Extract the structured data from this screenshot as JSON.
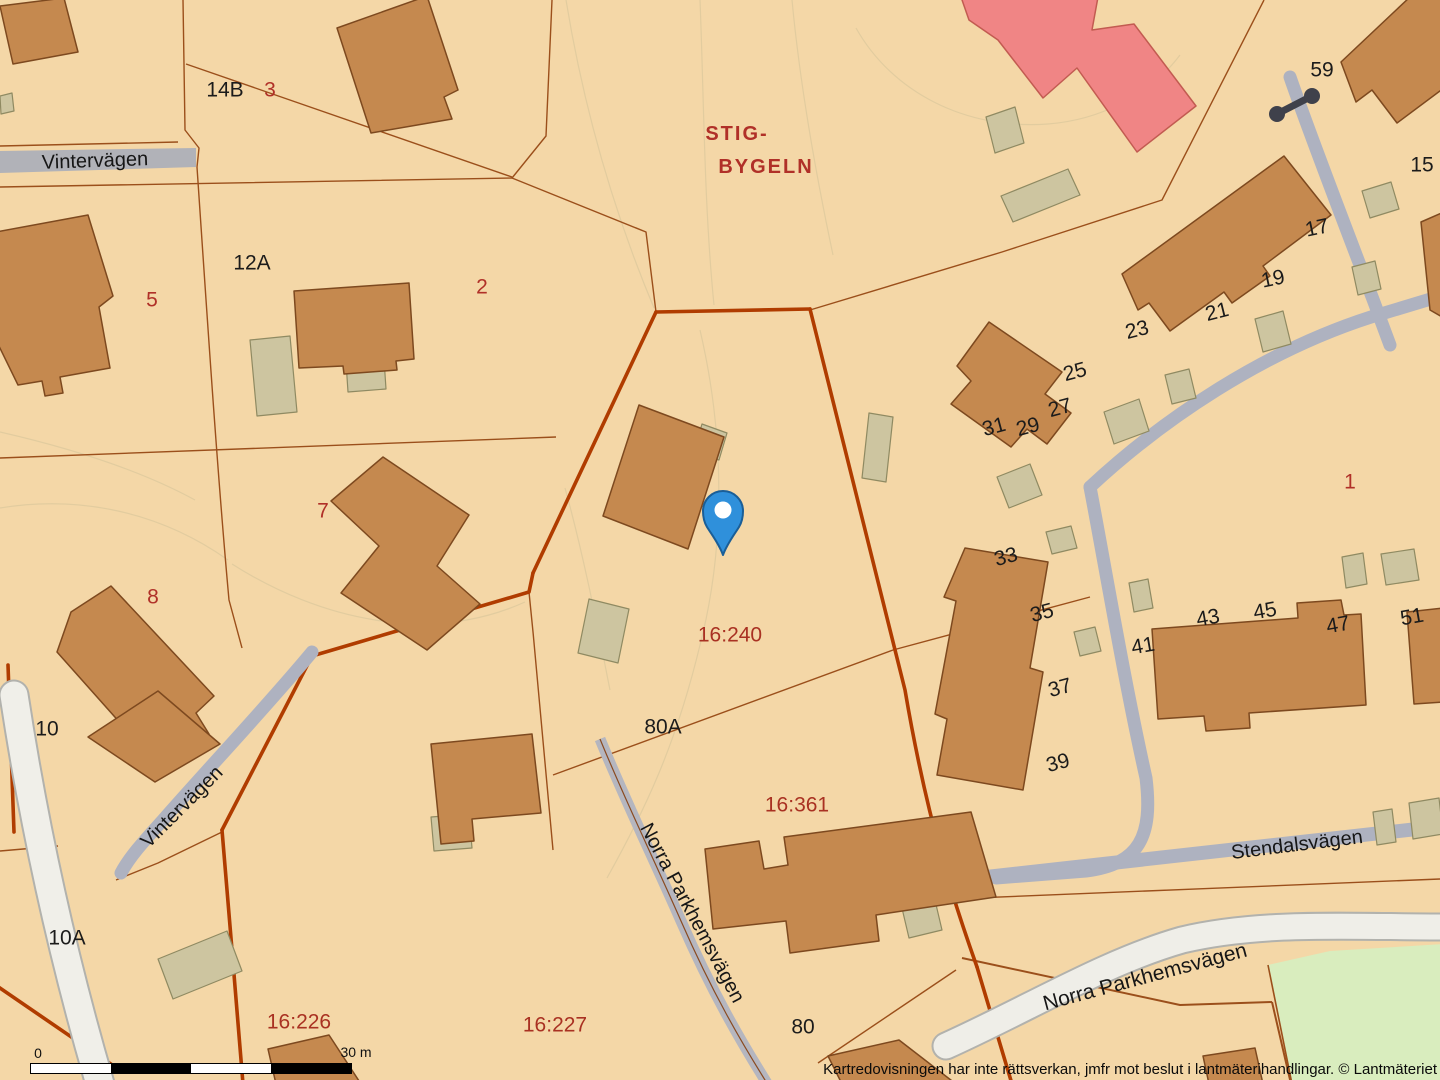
{
  "map": {
    "attribution": "Kartredovisningen har inte rättsverkan, jmfr mot beslut i lantmäterihandlingar. © Lantmäteriet",
    "scale_bar": {
      "zero": "0",
      "max": "30 m"
    },
    "area_name": {
      "line1": "STIG-",
      "line2": "BYGELN"
    },
    "marker": {
      "name": "location-pin"
    },
    "streets": [
      {
        "text": "Vintervägen"
      },
      {
        "text": "Vintervägen"
      },
      {
        "text": "Norra Parkhemsvägen"
      },
      {
        "text": "Norra Parkhemsvägen"
      },
      {
        "text": "Stendalsvägen"
      }
    ],
    "parcel_ids": [
      {
        "text": "16:240"
      },
      {
        "text": "16:361"
      },
      {
        "text": "16:226"
      },
      {
        "text": "16:227"
      }
    ],
    "black_numbers": [
      {
        "text": "14B"
      },
      {
        "text": "12A"
      },
      {
        "text": "10"
      },
      {
        "text": "10A"
      },
      {
        "text": "80A"
      },
      {
        "text": "80"
      },
      {
        "text": "59"
      },
      {
        "text": "15"
      },
      {
        "text": "17"
      },
      {
        "text": "19"
      },
      {
        "text": "21"
      },
      {
        "text": "23"
      },
      {
        "text": "25"
      },
      {
        "text": "27"
      },
      {
        "text": "29"
      },
      {
        "text": "31"
      },
      {
        "text": "33"
      },
      {
        "text": "35"
      },
      {
        "text": "37"
      },
      {
        "text": "39"
      },
      {
        "text": "41"
      },
      {
        "text": "43"
      },
      {
        "text": "45"
      },
      {
        "text": "47"
      },
      {
        "text": "51"
      }
    ],
    "red_numbers": [
      {
        "text": "3"
      },
      {
        "text": "5"
      },
      {
        "text": "2"
      },
      {
        "text": "7"
      },
      {
        "text": "8"
      },
      {
        "text": "1"
      }
    ],
    "colors": {
      "parcel_bg": "#F4D7A7",
      "building": "#C5894F",
      "outbuilding": "#CDC5A0",
      "highlight_building": "#F08585",
      "road_minor": "#AEB2C0",
      "road_major": "#EFEEE8",
      "green_area": "#D9EDBE",
      "boundary_thick": "#B03C00",
      "boundary_thin": "#9B4F1B",
      "red_label": "#B03028",
      "pin_blue": "#2F90DB"
    }
  }
}
